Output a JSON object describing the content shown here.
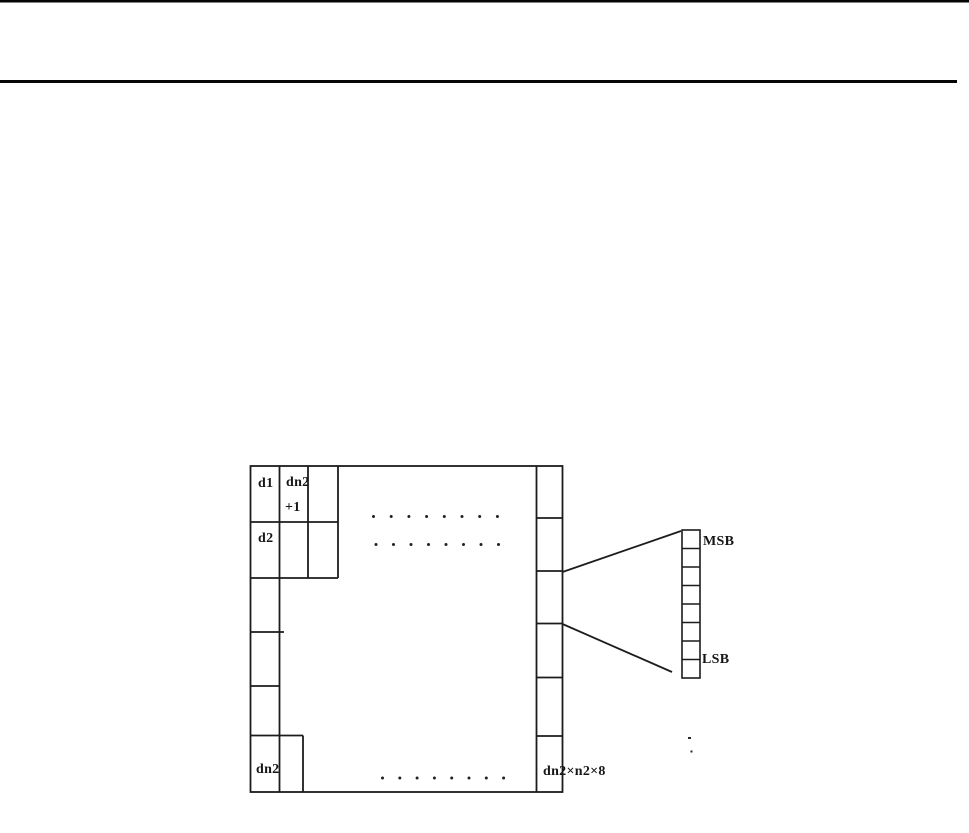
{
  "figure": {
    "grid_labels": {
      "d1": "d1",
      "dn2_plus1_line1": "dn2",
      "dn2_plus1_line2": "+1",
      "d2": "d2",
      "dn2_bottom": "dn2",
      "total_expression": "dn2×n2×8"
    },
    "detail_labels": {
      "msb": "MSB",
      "lsb": "LSB"
    },
    "detail_bit_cells": 8,
    "ellipsis_rows": 3,
    "ellipsis_dots_per_row": 8,
    "colors": {
      "ink": "#1c1c1c",
      "paper": "#ffffff"
    }
  }
}
